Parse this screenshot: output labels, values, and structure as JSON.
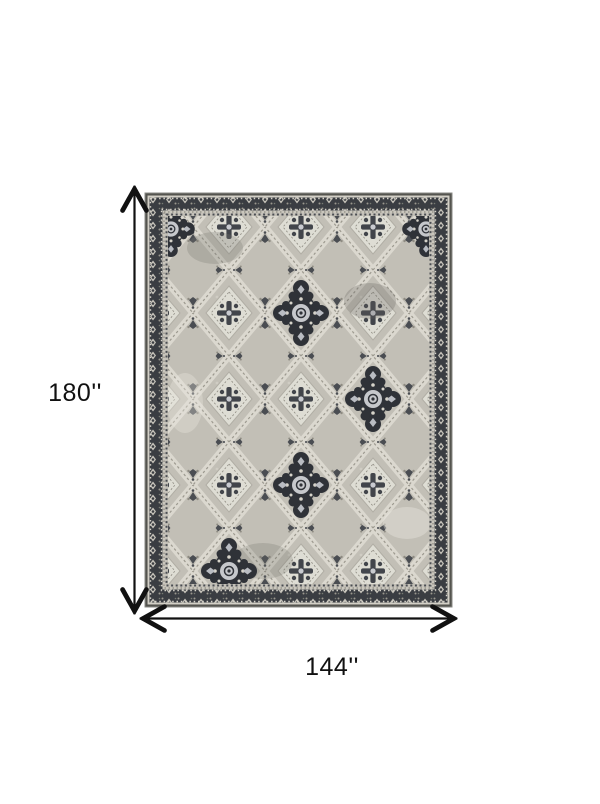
{
  "page": {
    "background": "#ffffff",
    "content_type": "product dimension diagram of an area rug"
  },
  "diagram": {
    "height_label": "180''",
    "width_label": "144''",
    "line_color": "#111111",
    "label_color": "#111111"
  },
  "rug": {
    "description": "gray distressed oriental lattice-medallion area rug",
    "palette": {
      "field": "#c2bfb6",
      "ivory": "#dbd8cf",
      "border_charcoal": "#3a3d42",
      "dark_motif": "#2f3238",
      "rosette_blue_gray": "#c9cbd0",
      "edge_dark": "#54544f",
      "guard_beige": "#c9c6bd"
    }
  }
}
